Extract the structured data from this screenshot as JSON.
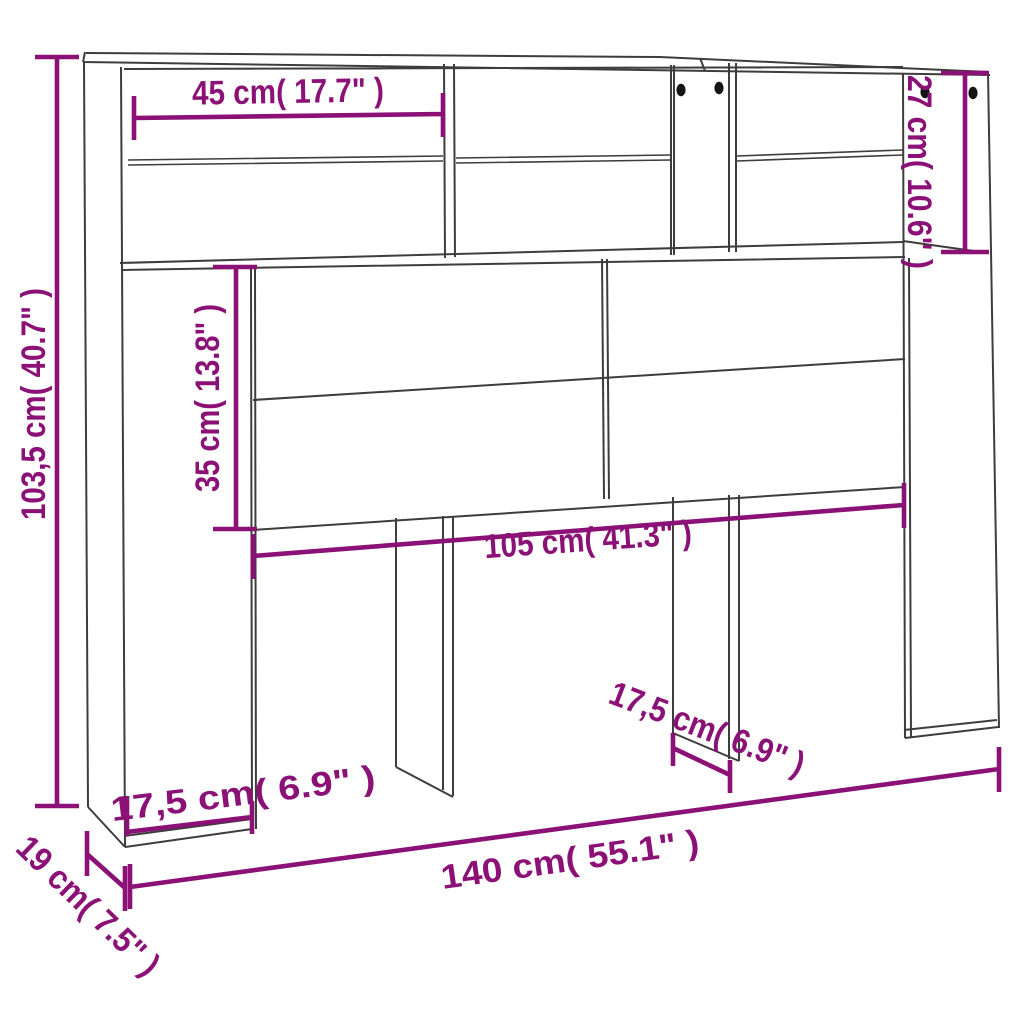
{
  "meta": {
    "description": "Technical line-drawing dimension diagram of a headboard storage cabinet with open shelves, two rear legs and side compartments",
    "view": "front perspective"
  },
  "colors": {
    "background": "#ffffff",
    "outline": "#3d3d3d",
    "dimension_accent": "#8b1176",
    "hole_dot": "#141414"
  },
  "holes": {
    "count": 4,
    "icon": "screw-hole-dot"
  },
  "dimensions": {
    "total_height": {
      "label": "103,5 cm( 40.7\" )"
    },
    "shelf_width": {
      "label": "45 cm( 17.7\" )"
    },
    "top_right_height": {
      "label": "27 cm( 10.6\" )"
    },
    "panel_height": {
      "label": "35 cm( 13.8\" )"
    },
    "inner_width": {
      "label": "105 cm( 41.3\" )"
    },
    "side_width": {
      "label": "17,5 cm( 6.9\" )"
    },
    "leg_width": {
      "label": "17,5 cm( 6.9\" )"
    },
    "total_width": {
      "label": "140 cm( 55.1\" )"
    },
    "depth": {
      "label": "19 cm( 7.5\" )"
    }
  }
}
